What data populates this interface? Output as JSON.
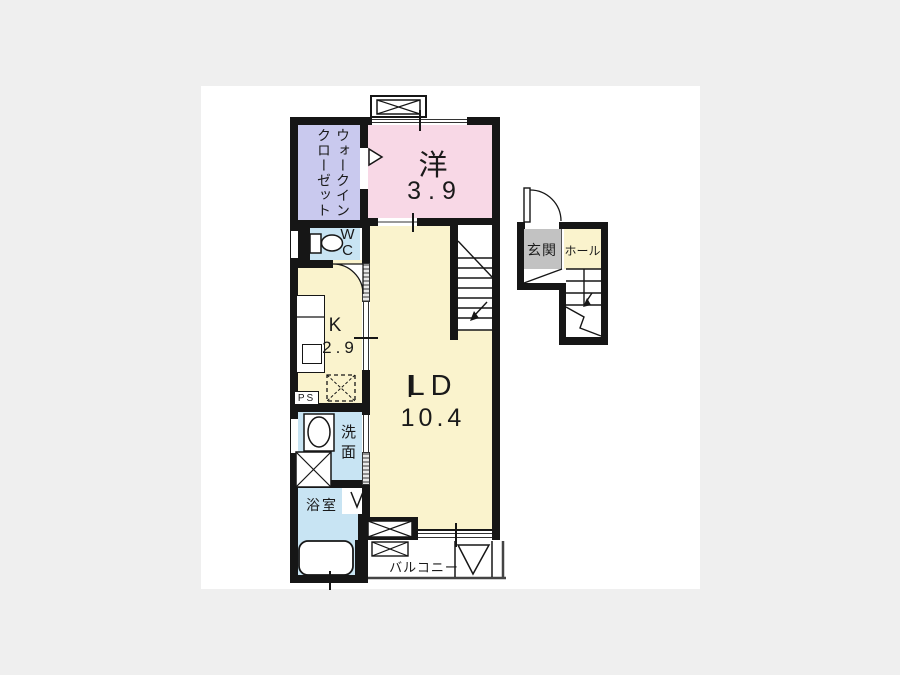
{
  "floorplan": {
    "background_color": "#efefef",
    "paper_color": "#ffffff",
    "wall_color": "#161616",
    "rooms": {
      "walk_in_closet": {
        "label": "ウォークインクローゼット",
        "label_lines": [
          "ウォークイン",
          "クローゼット"
        ],
        "color": "#c9c9ee"
      },
      "western_room": {
        "label": "洋",
        "size": "3.9",
        "color": "#f8d8e6"
      },
      "wc": {
        "label": "WC",
        "color": "#c8e4f3"
      },
      "kitchen": {
        "label": "K",
        "size": "2.9",
        "color": "#faf3cd"
      },
      "living_dining": {
        "label": "LD",
        "size": "10.4",
        "color": "#faf3cd"
      },
      "pipe_space": {
        "label": "PS"
      },
      "washroom": {
        "label": "洗面",
        "color": "#c8e4f3"
      },
      "bathroom": {
        "label": "浴室",
        "color": "#c8e4f3"
      },
      "balcony": {
        "label": "バルコニー"
      },
      "entrance": {
        "label": "玄関",
        "color": "#c2c2c2"
      },
      "hall": {
        "label": "ホール",
        "color": "#faf3cd"
      }
    }
  }
}
